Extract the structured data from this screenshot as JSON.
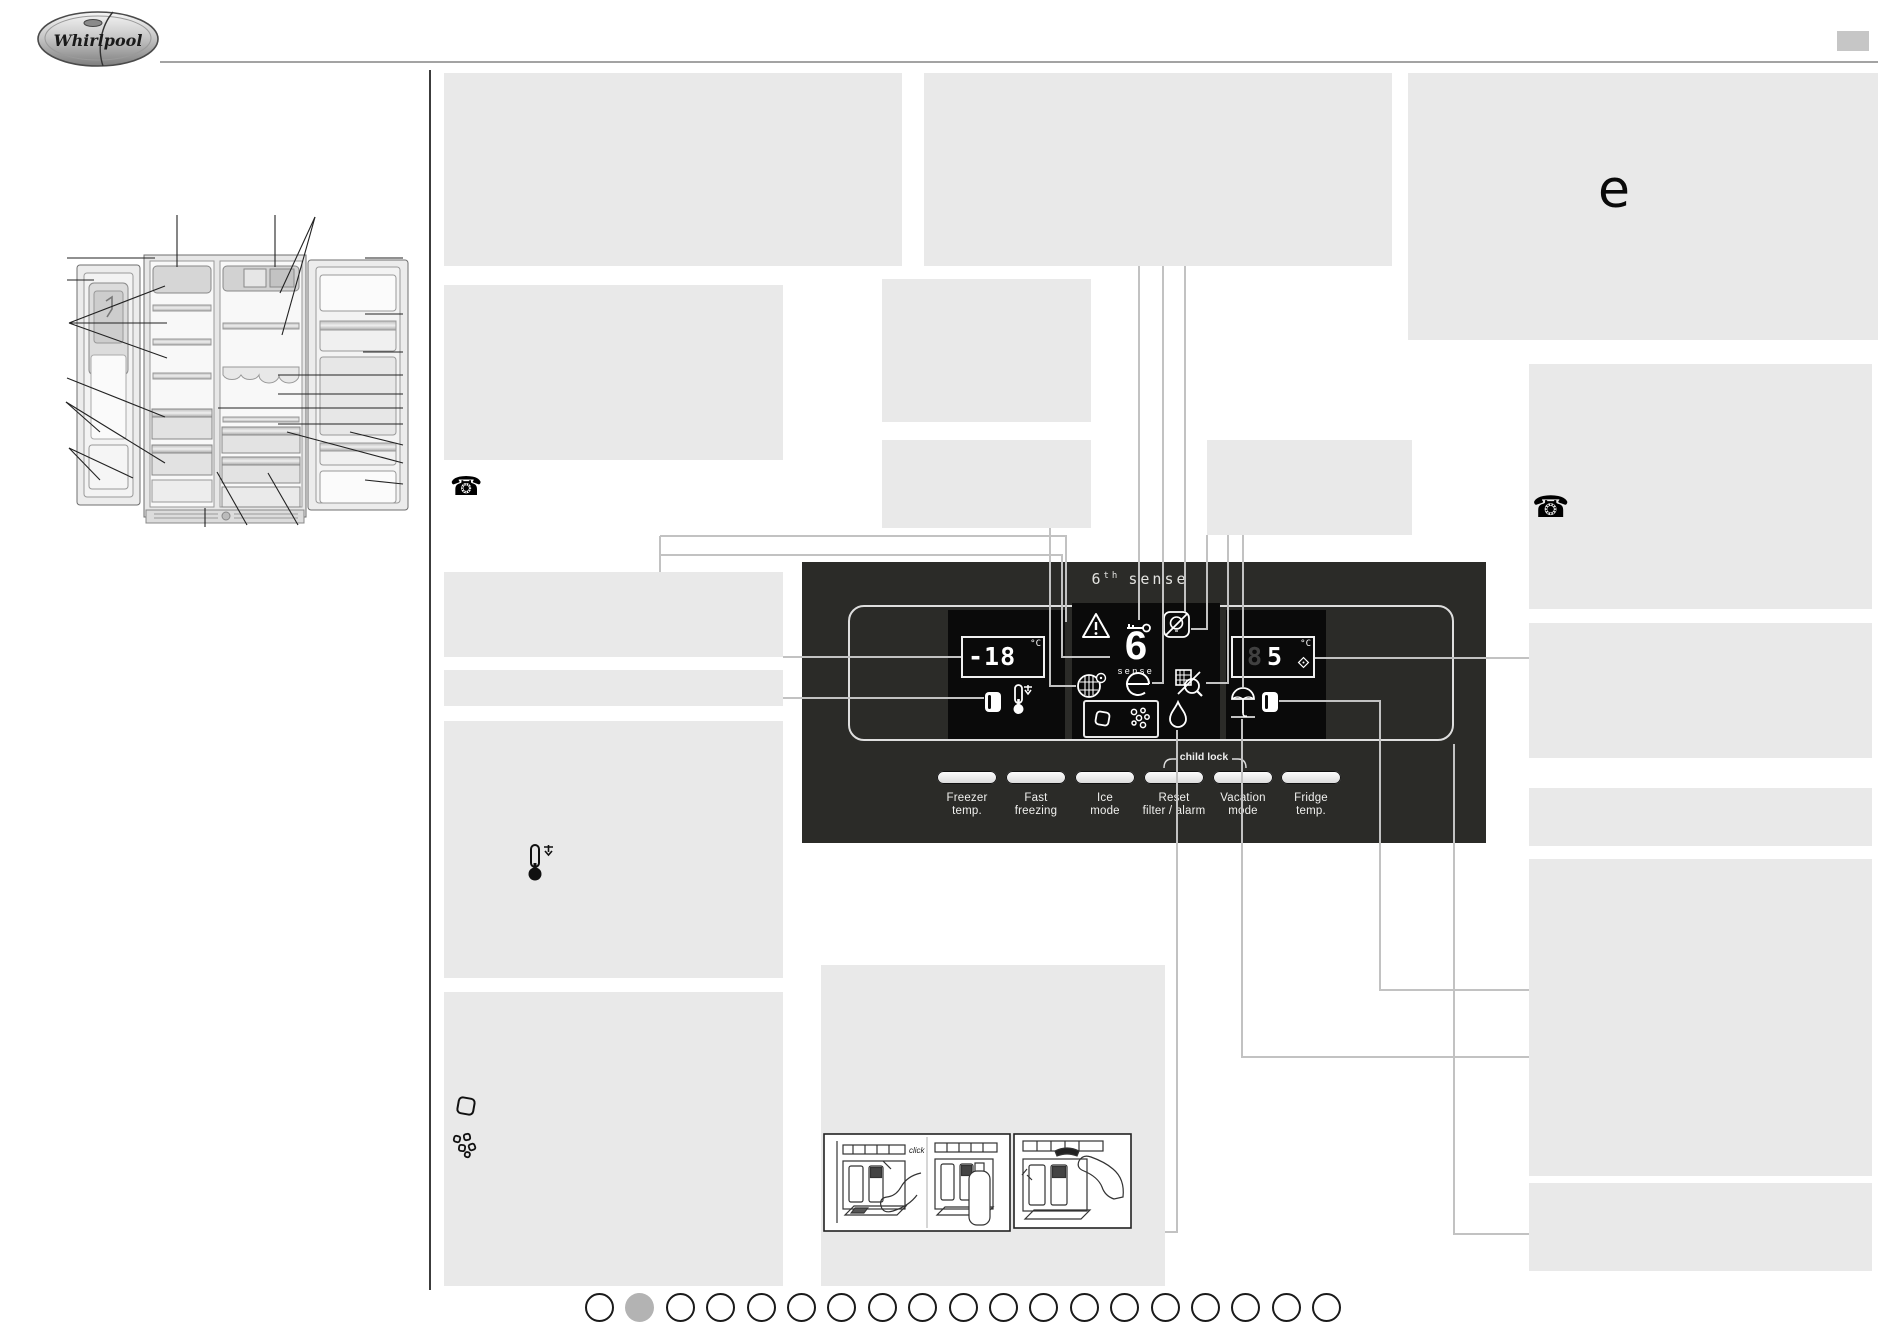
{
  "brand": {
    "name": "Whirlpool"
  },
  "energy_symbol": "e",
  "phone_glyph": "☎",
  "control_panel": {
    "title": {
      "six": "6",
      "sup": "th",
      "word": "sense"
    },
    "sense_logo": {
      "six": "6",
      "word": "sense"
    },
    "freezer_display": {
      "value": "-18",
      "unit": "°C"
    },
    "fridge_display": {
      "ghost_digit": "8",
      "value": "5",
      "unit": "°C"
    },
    "child_lock_label": "child lock",
    "buttons": [
      {
        "line1": "Freezer",
        "line2": "temp."
      },
      {
        "line1": "Fast",
        "line2": "freezing"
      },
      {
        "line1": "Ice",
        "line2": "mode"
      },
      {
        "line1": "Reset",
        "line2": "filter / alarm"
      },
      {
        "line1": "Vacation",
        "line2": "mode"
      },
      {
        "line1": "Fridge",
        "line2": "temp."
      }
    ],
    "indicator_icons": [
      "warning-icon",
      "key-icon",
      "light-off-icon",
      "water-filter-icon",
      "eco-mode-icon",
      "sensor-off-icon",
      "freezer-door-icon",
      "temp-down-icon",
      "ice-cube-icon",
      "crushed-ice-icon",
      "water-drop-icon",
      "vacation-umbrella-icon",
      "fridge-door-icon"
    ]
  },
  "side_icons": [
    "phone-icon",
    "thermometer-down-icon",
    "ice-cube-icon",
    "crushed-ice-icon",
    "energy-e-symbol"
  ],
  "illustration_note": "click",
  "pagination": {
    "count": 19,
    "active": 2
  },
  "colors": {
    "panel_bg": "#2b2b28",
    "display_bg": "#0a0a0a",
    "placeholder": "#e9e9e9",
    "callout": "#c2c2c2",
    "dot_fill": "#b3b3b3",
    "white": "#ffffff"
  }
}
